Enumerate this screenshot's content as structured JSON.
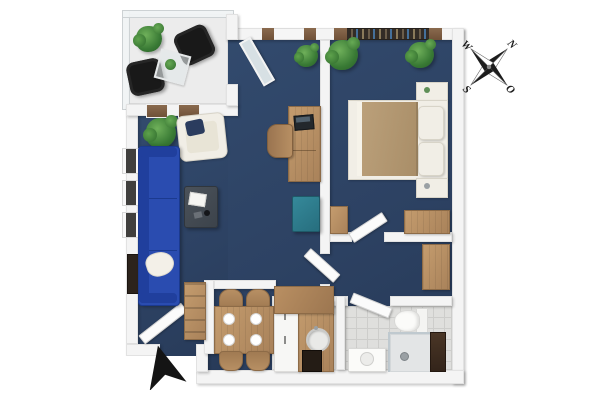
{
  "scene": {
    "type": "3d-floor-plan-top-view",
    "description": "Top-down 3D rendering of a one-bedroom apartment: dark blue floors, white walls, balcony with black chairs, living/dining room, kitchen nook, bedroom, hallway and bathroom",
    "background": "#ffffff"
  },
  "compass": {
    "north": "N",
    "east": "O",
    "south": "S",
    "west": "W"
  },
  "entrance": {
    "marker": "black arrow pointing at front door"
  },
  "palette": {
    "floor": "#2d4263",
    "walls": "#f4f4f4",
    "wood": "#b9916a",
    "dark_wood": "#3a2b20",
    "sofa": "#2a4cb0",
    "ottoman": "#2f8494",
    "balcony_floor": "#ececec",
    "bath_tile": "#dfdfdd",
    "outdoor_chairs": "#191919",
    "plants": "#3f8a3f",
    "bed_blanket": "#b69b75",
    "coffee_table": "#454c54"
  },
  "rooms": [
    {
      "id": "balcony",
      "furniture": [
        "black lounge chair",
        "black lounge chair",
        "glass side table with small plant",
        "potted plant"
      ]
    },
    {
      "id": "living-room",
      "furniture": [
        "blue three-seat sofa with white throw",
        "white armchair with navy cushion",
        "dark coffee table with book and mug",
        "wall-mounted TV",
        "teal ottoman",
        "wooden desk with laptop",
        "wooden desk chair",
        "two potted plants"
      ]
    },
    {
      "id": "dining-area",
      "furniture": [
        "wooden dining table",
        "four wooden chairs",
        "four place settings",
        "tall wooden shelf unit"
      ]
    },
    {
      "id": "kitchen",
      "furniture": [
        "white cabinet run",
        "wooden L-counter",
        "round sink",
        "oven"
      ]
    },
    {
      "id": "bedroom",
      "furniture": [
        "double bed with tan blanket and white pillows",
        "two nightstands",
        "wooden wardrobe",
        "small wooden dresser",
        "two potted plants"
      ]
    },
    {
      "id": "hallway",
      "furniture": [
        "tall wooden wardrobe"
      ]
    },
    {
      "id": "bathroom",
      "furniture": [
        "toilet",
        "white washbasin cabinet",
        "walk-in shower with dark wood panel"
      ]
    }
  ],
  "windows": {
    "left_wall_count": 3,
    "top_wall_living_count": 1,
    "bedroom_count": 1,
    "under_balcony_count": 2
  },
  "doors": [
    "front door",
    "balcony glass door",
    "hallway door",
    "bedroom door",
    "bathroom door"
  ]
}
